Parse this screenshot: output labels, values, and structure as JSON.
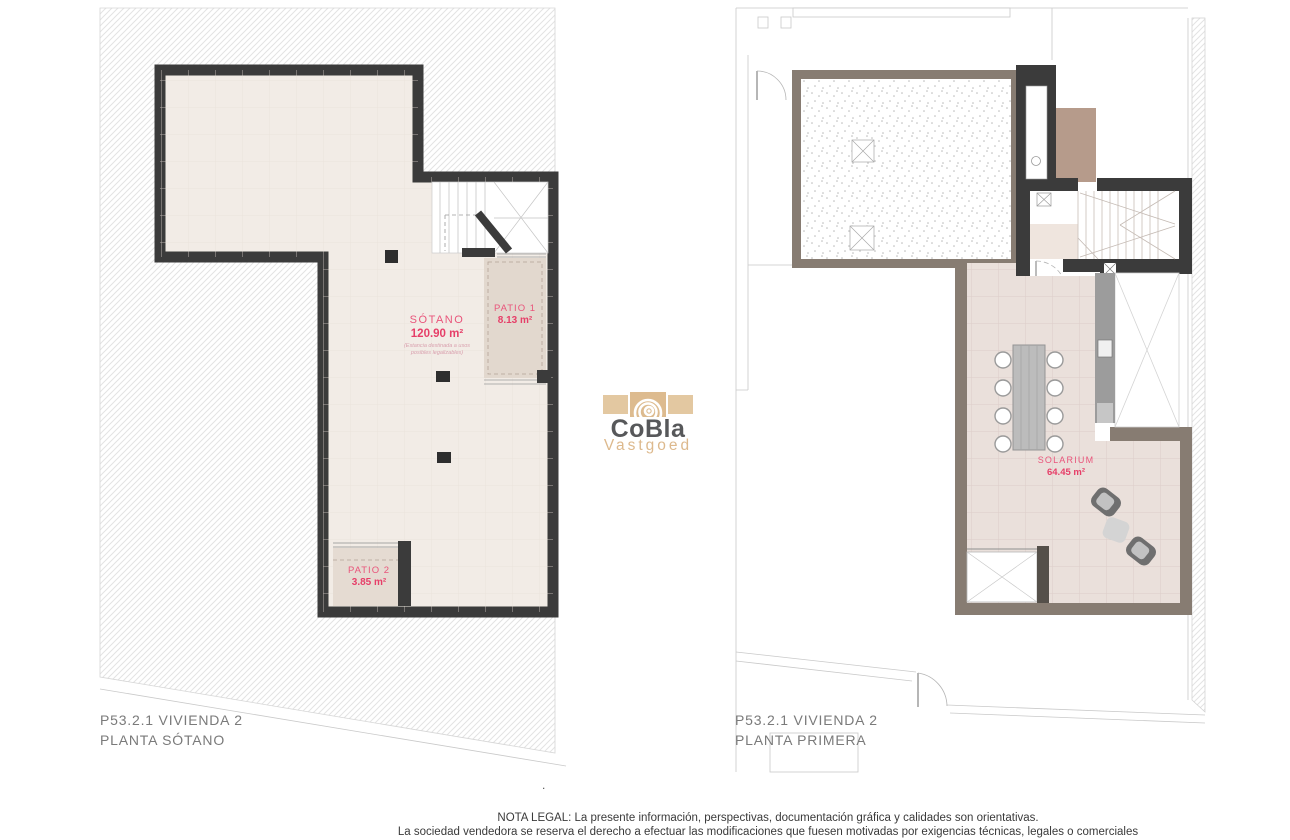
{
  "logo": {
    "brand": "CoBla",
    "subtitle": "Vastgoed"
  },
  "left_plan": {
    "title_line1": "P53.2.1 VIVIENDA 2",
    "title_line2": "PLANTA SÓTANO",
    "rooms": {
      "sotano": {
        "name": "SÓTANO",
        "area": "120.90 m²",
        "note_line1": "(Estancia destinada a usos",
        "note_line2": "posibles legalizables)"
      },
      "patio1": {
        "name": "PATIO 1",
        "area": "8.13 m²"
      },
      "patio2": {
        "name": "PATIO 2",
        "area": "3.85 m²"
      }
    }
  },
  "right_plan": {
    "title_line1": "P53.2.1 VIVIENDA 2",
    "title_line2": "PLANTA PRIMERA",
    "rooms": {
      "solarium": {
        "name": "SOLARIUM",
        "area": "64.45 m²"
      }
    }
  },
  "footer": {
    "separator_dot": ".",
    "legal_line1": "NOTA LEGAL: La presente información, perspectivas, documentación gráfica y calidades son orientativas.",
    "legal_line2": "La sociedad vendedora se reserva el derecho a efectuar las modificaciones que fuesen motivadas por exigencias técnicas, legales o comerciales"
  },
  "colors": {
    "accent_pink": "#e6456e",
    "wall_dark": "#3b3b3b",
    "wall_taupe": "#877c72",
    "floor_beige": "#f2ece6",
    "tile_rose": "#eae0db",
    "brand_tan": "#ddb98d",
    "brand_gray": "#57585a",
    "label_gray": "#7a7a7a"
  }
}
